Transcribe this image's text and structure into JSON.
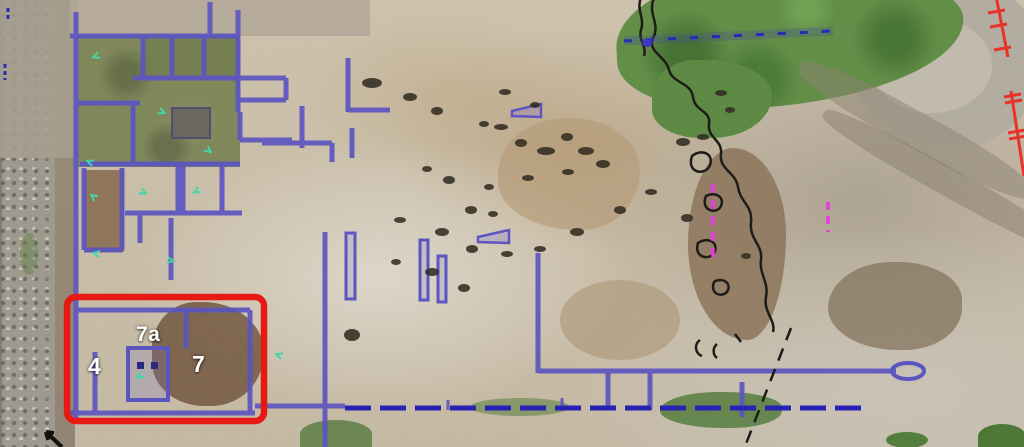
{
  "annotations": {
    "room_labels": [
      {
        "id": "room-4",
        "text": "4"
      },
      {
        "id": "room-7a",
        "text": "7a"
      },
      {
        "id": "room-7",
        "text": "7"
      }
    ]
  },
  "colors": {
    "wall_blue": "#5b55c0",
    "wall_navy": "#2722b4",
    "highlight_red": "#e51a12",
    "survey_magenta": "#e93ce0",
    "survey_red": "#e8322a",
    "marker_cyan": "#3fd8a8",
    "trench_black": "#1d1c18",
    "label_white": "#ffffff"
  }
}
